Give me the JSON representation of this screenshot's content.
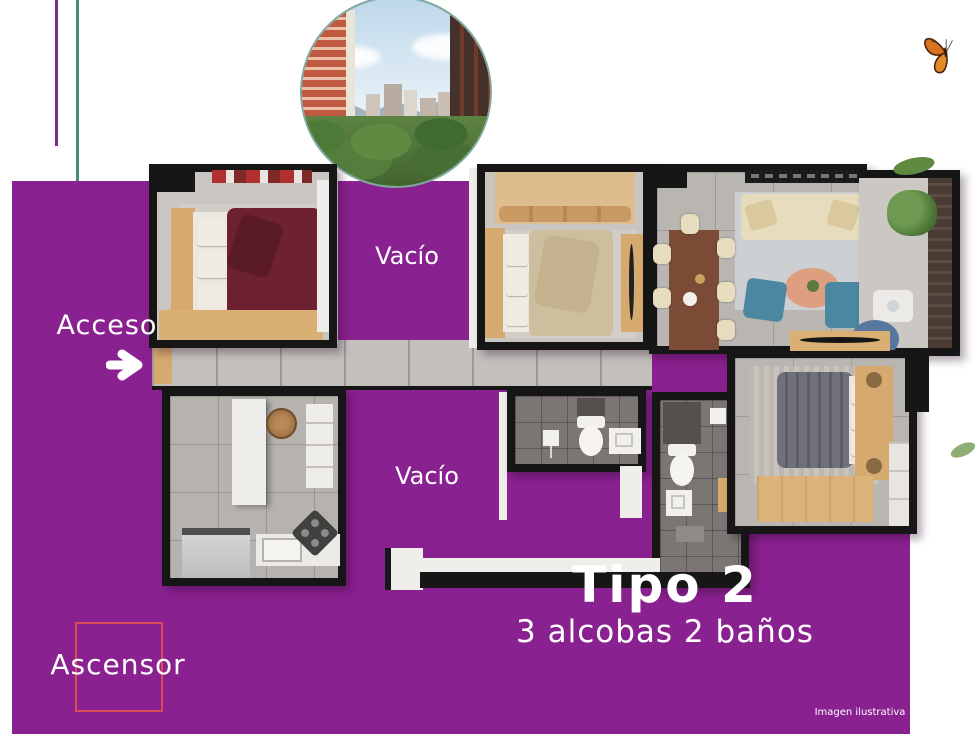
{
  "labels": {
    "acceso": "Acceso",
    "vacio_upper": "Vacío",
    "vacio_lower": "Vacío",
    "ascensor": "Ascensor"
  },
  "plan_title": {
    "type": "Tipo 2",
    "features": "3 alcobas 2 baños"
  },
  "footnote": "Imagen ilustrativa",
  "colors": {
    "background_accent": "#8a2190",
    "purple_line": "#7b2f8a",
    "teal_line": "#448b7e",
    "ascensor_box": "#d94b55",
    "wall": "#161616",
    "butterfly": "#d9731f"
  }
}
